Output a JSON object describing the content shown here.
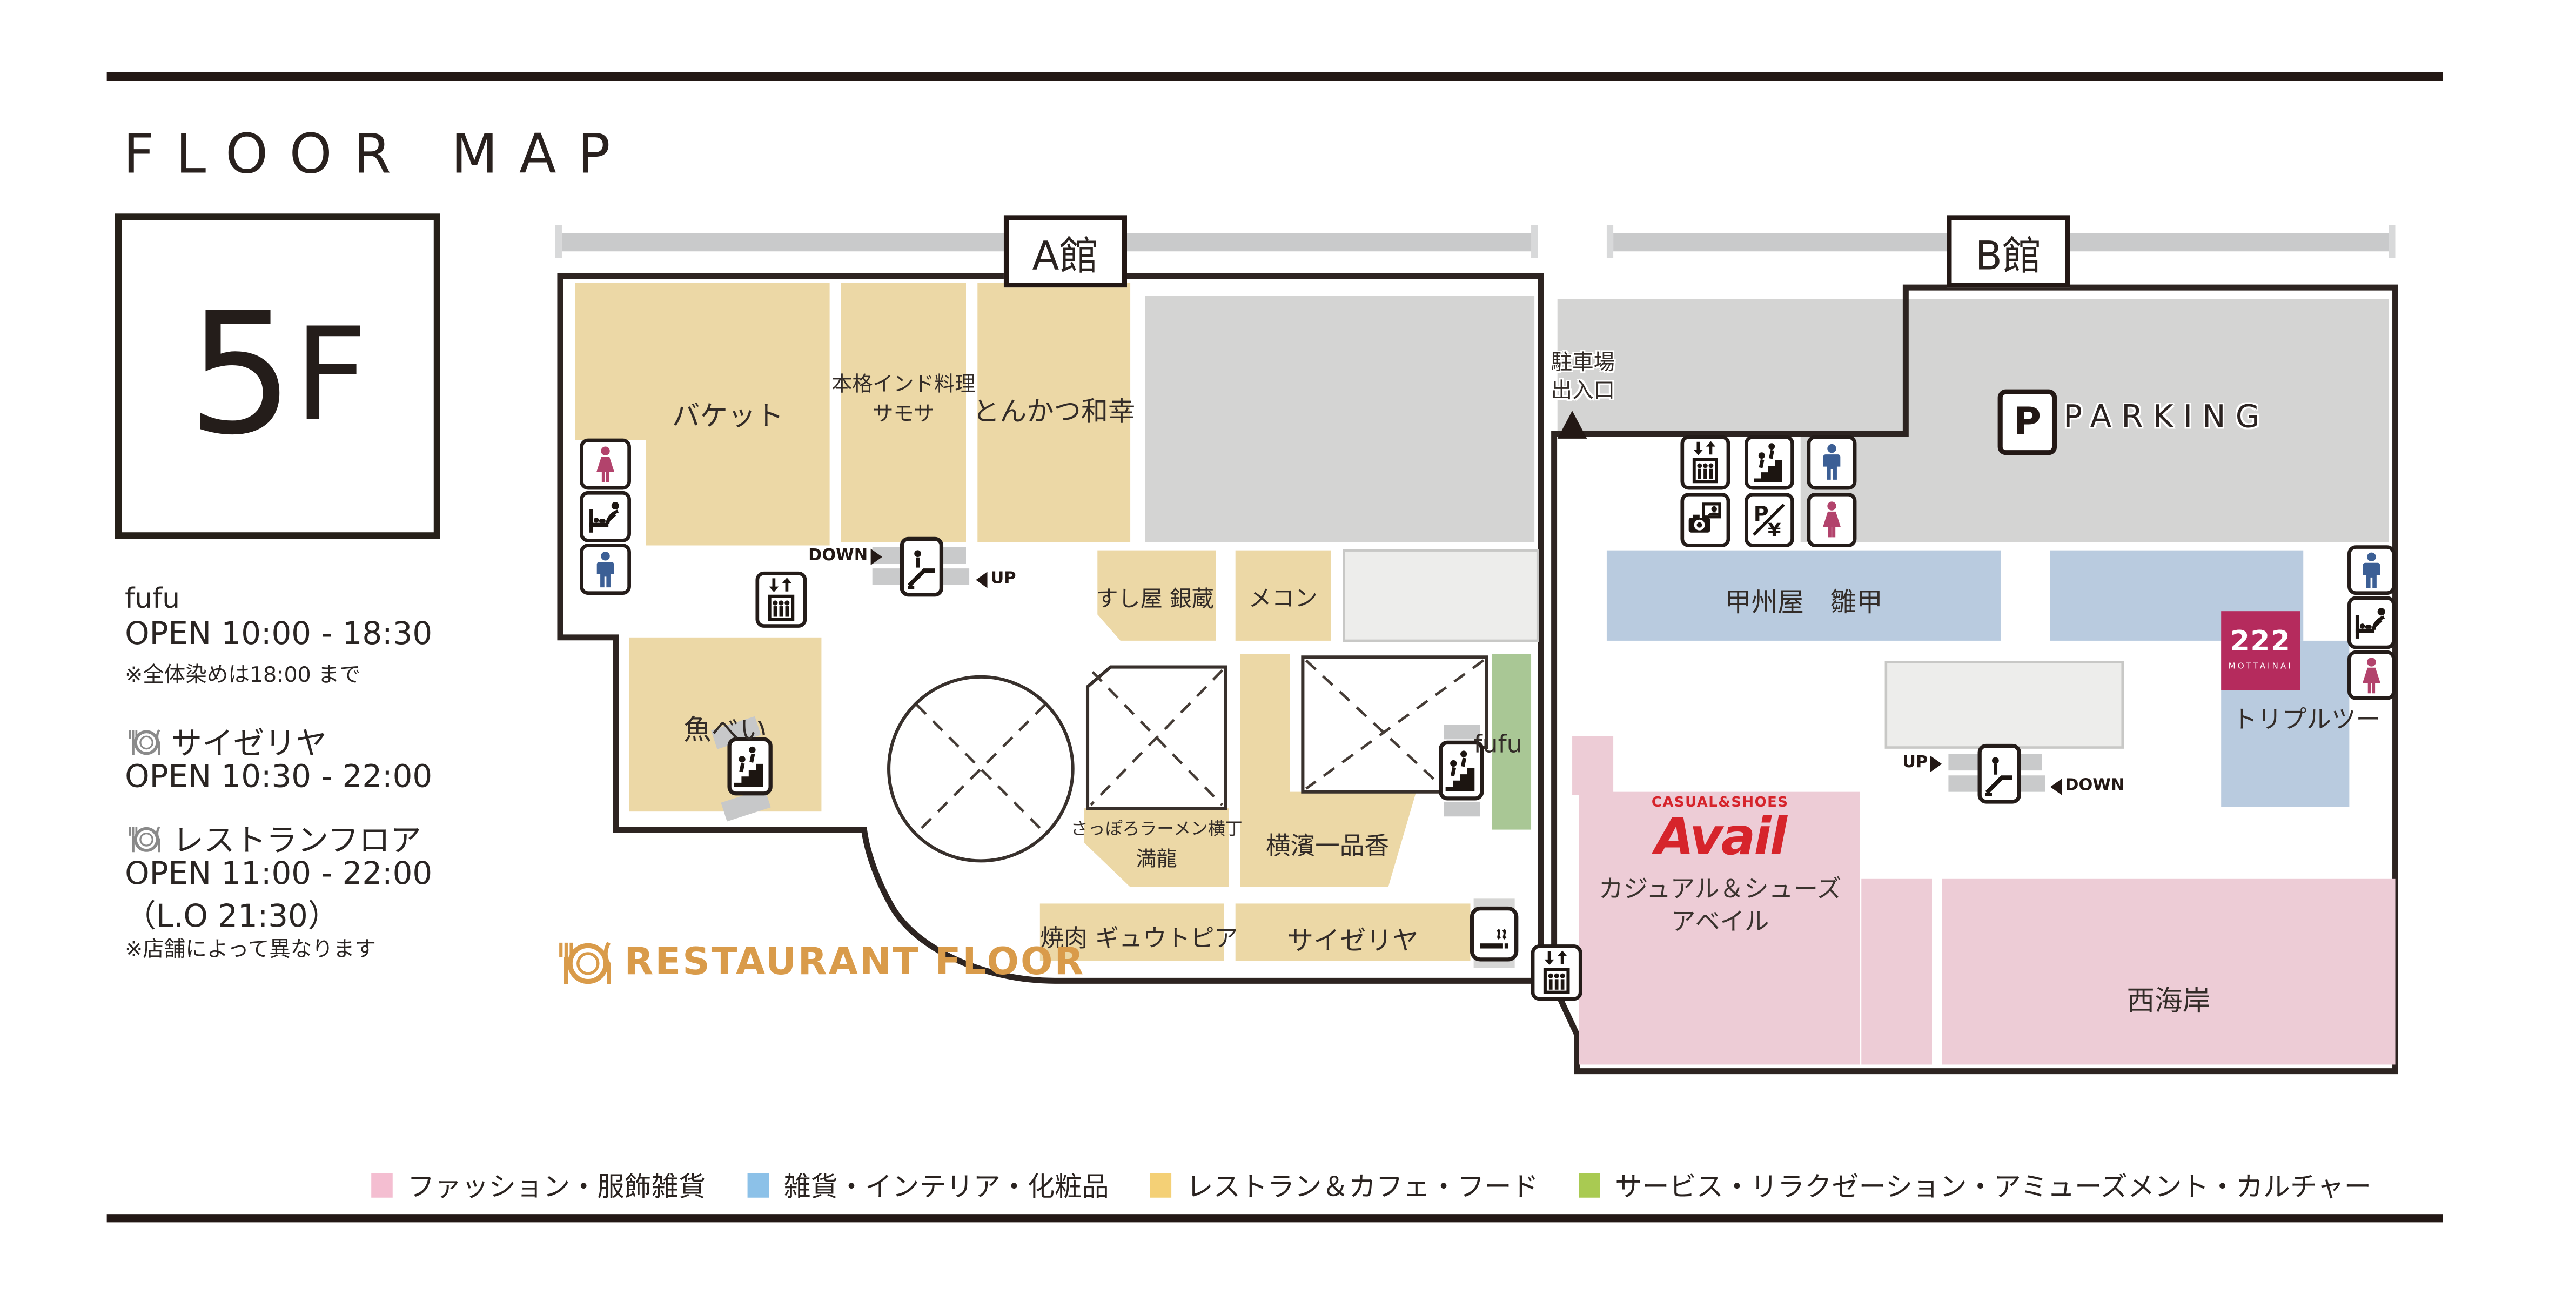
{
  "page": {
    "title": "FLOOR MAP"
  },
  "floor": {
    "number": "5",
    "suffix": "F"
  },
  "hours": [
    {
      "name": "fufu",
      "open": "OPEN  10:00 - 18:30",
      "note": "※全体染めは18:00 まで"
    },
    {
      "name": "サイゼリヤ",
      "open": "OPEN  10:30 - 22:00"
    },
    {
      "name": "レストランフロア",
      "open": "OPEN  11:00 - 22:00",
      "extra": "（L.O  21:30）",
      "note": "※店舗によって異なります"
    }
  ],
  "buildings": {
    "a": "A館",
    "b": "B館"
  },
  "stores": {
    "bucket": "バケット",
    "samosa_line1": "本格インド料理",
    "samosa_line2": "サモサ",
    "tonkatsu": "とんかつ和幸",
    "sushi_ginzo": "すし屋 銀蔵",
    "mekong": "メコン",
    "uobei": "魚べい",
    "sapporo_ramen": "さっぽろラーメン横丁",
    "manryu": "満龍",
    "yokohama_ippinko": "横濱一品香",
    "fufu": "fufu",
    "yakiniku": "焼肉 ギュウトピア",
    "saizeriya": "サイゼリヤ",
    "koshuya": "甲州屋　雛甲",
    "triple_two": "トリプルツー",
    "nishikaigan": "西海岸"
  },
  "avail": {
    "tagline": "CASUAL&SHOES",
    "logo": "Avail",
    "name_line1": "カジュアル＆シューズ",
    "name_line2": "アベイル"
  },
  "t222": {
    "logo": "222",
    "sub": "MOTTAINAI",
    "name": "トリプルツー"
  },
  "map_labels": {
    "parking_entrance_line1": "駐車場",
    "parking_entrance_line2": "出入口",
    "p": "P",
    "parking": "PARKING",
    "down": "DOWN",
    "up": "UP",
    "restaurant_floor": "RESTAURANT FLOOR"
  },
  "legend": [
    {
      "label": "ファッション・服飾雑貨",
      "color": "#f4bed1"
    },
    {
      "label": "雑貨・インテリア・化粧品",
      "color": "#8cc1e8"
    },
    {
      "label": "レストラン＆カフェ・フード",
      "color": "#f4d076"
    },
    {
      "label": "サービス・リラクゼーション・アミューズメント・カルチャー",
      "color": "#a9ca52"
    }
  ],
  "colors": {
    "restaurant_block": "#ecd8a6",
    "fashion_block": "#edccd6",
    "goods_block": "#b9cbdf",
    "service_block": "#a9c795",
    "parking_gray": "#d4d4d3",
    "accent_orange": "#d99b4a",
    "avail_red": "#d6242b",
    "t222_bg": "#b52b5d",
    "male_blue": "#3c5f95",
    "female_red": "#b2436c",
    "outline": "#2d2421"
  }
}
